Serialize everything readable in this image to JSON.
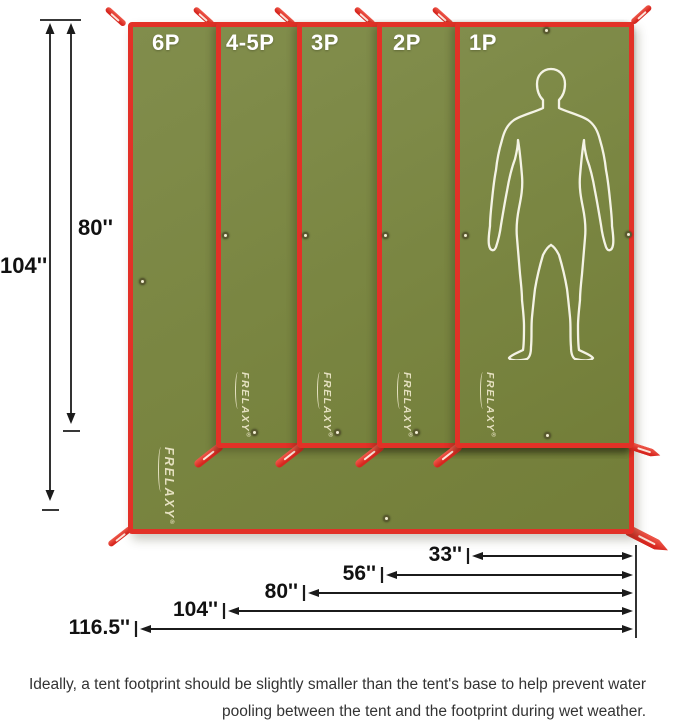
{
  "brand": {
    "name": "FRELAXY",
    "registered": "®"
  },
  "panels": [
    {
      "label": "6P"
    },
    {
      "label": "4-5P"
    },
    {
      "label": "3P"
    },
    {
      "label": "2P"
    },
    {
      "label": "1P"
    }
  ],
  "dimensions": {
    "vertical": [
      {
        "value": "104''"
      },
      {
        "value": "80''"
      }
    ],
    "horizontal": [
      {
        "value": "33''"
      },
      {
        "value": "56''"
      },
      {
        "value": "80''"
      },
      {
        "value": "104''"
      },
      {
        "value": "116.5''"
      }
    ]
  },
  "caption": {
    "line1": "Ideally, a tent footprint should be slightly smaller than the tent's base to help prevent water",
    "line2": "pooling between the tent and the footprint during wet weather."
  },
  "icons": {
    "human_silhouette": "standing-man-outline",
    "grommet": "eyelet-ring",
    "corner_strap": "stake-out-loop"
  },
  "colors": {
    "tarp_green": "#7A8642",
    "trim_red": "#E23127",
    "logo_cream": "#EFE9CC",
    "dimension_black": "#1B1B1B",
    "caption_gray": "#333333"
  }
}
